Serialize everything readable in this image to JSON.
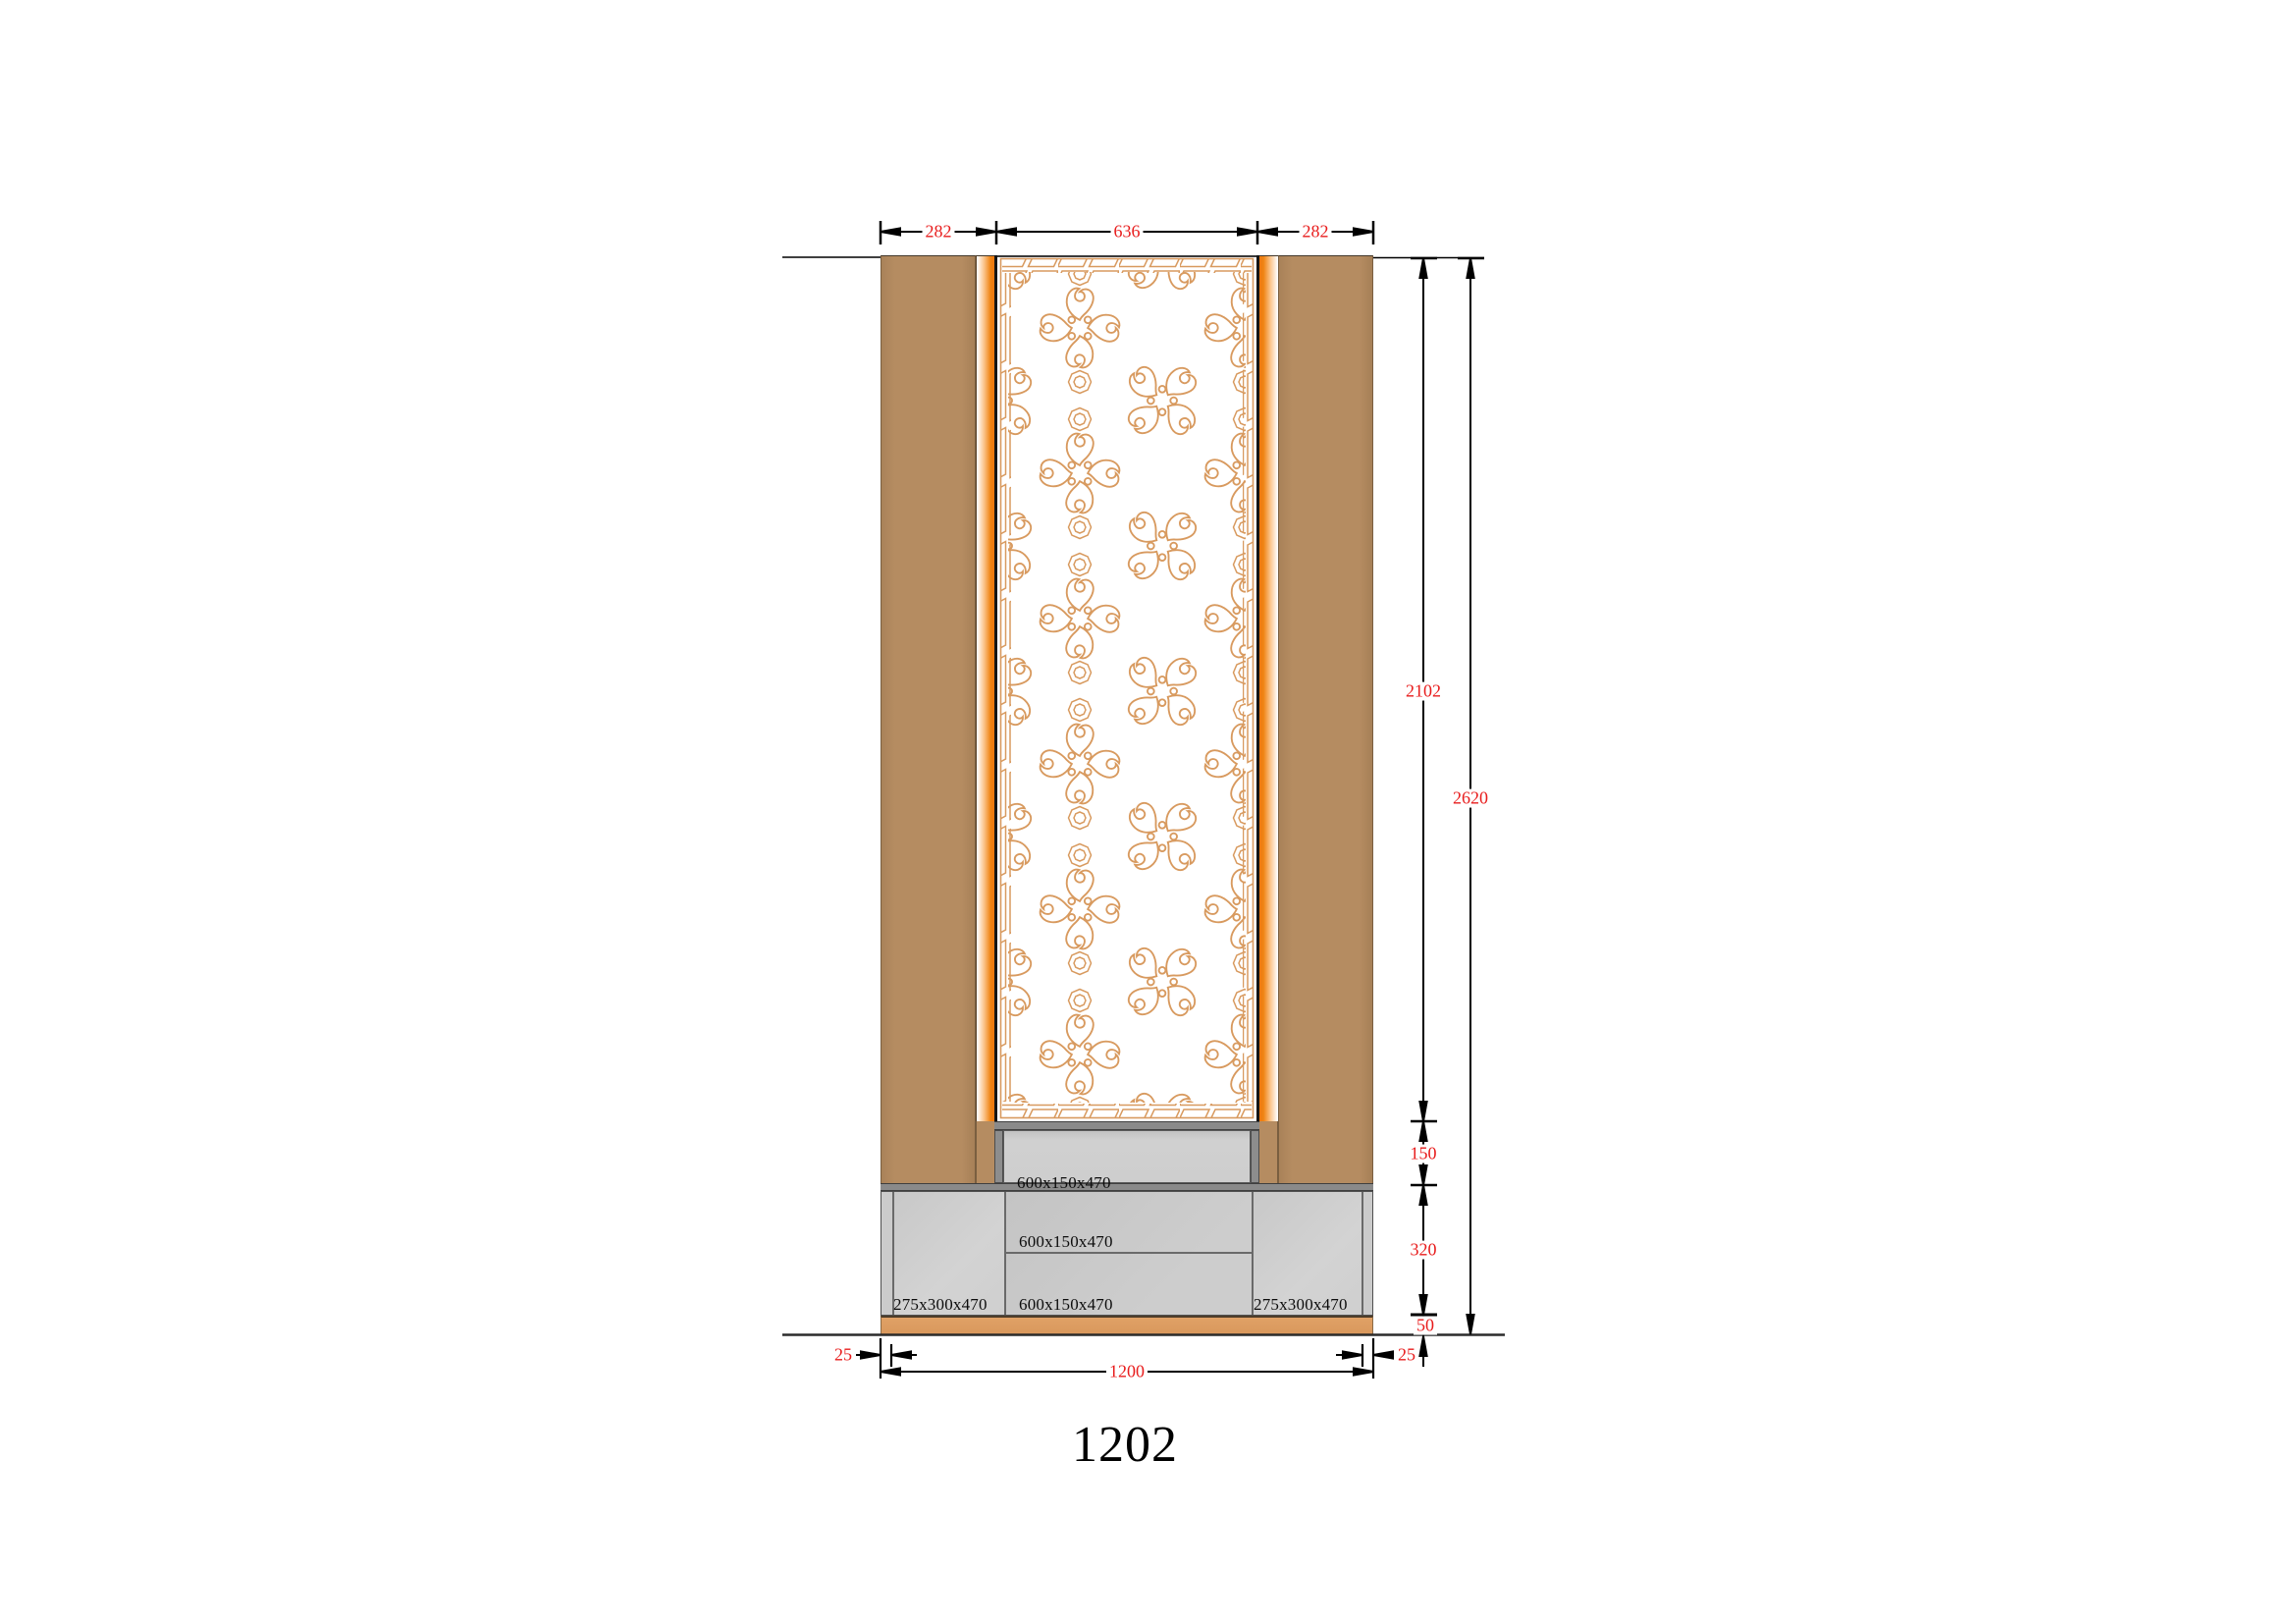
{
  "title": "1202",
  "dims": {
    "top_left": "282",
    "top_center": "636",
    "top_right": "282",
    "fret_height": "2102",
    "total_height": "2620",
    "drawer_height": "150",
    "cabinet_height": "320",
    "plinth_height": "50",
    "side_panel_left": "25",
    "side_panel_right": "25",
    "overall_width": "1200"
  },
  "labels": {
    "top_drawer": "600x150x470",
    "middle_drawer": "600x150x470",
    "bottom_drawer": "600x150x470",
    "left_cabinet": "275x300x470",
    "right_cabinet": "275x300x470"
  },
  "colors": {
    "wood": "#b58c61",
    "glow_orange": "#ee7a12",
    "fretwork_stroke": "#d89a5f",
    "plinth": "#db9a5e",
    "cabinet_gray": "#cbcbcb",
    "steel_gray": "#8a8a8a",
    "dimension_red": "#e81c1c"
  }
}
